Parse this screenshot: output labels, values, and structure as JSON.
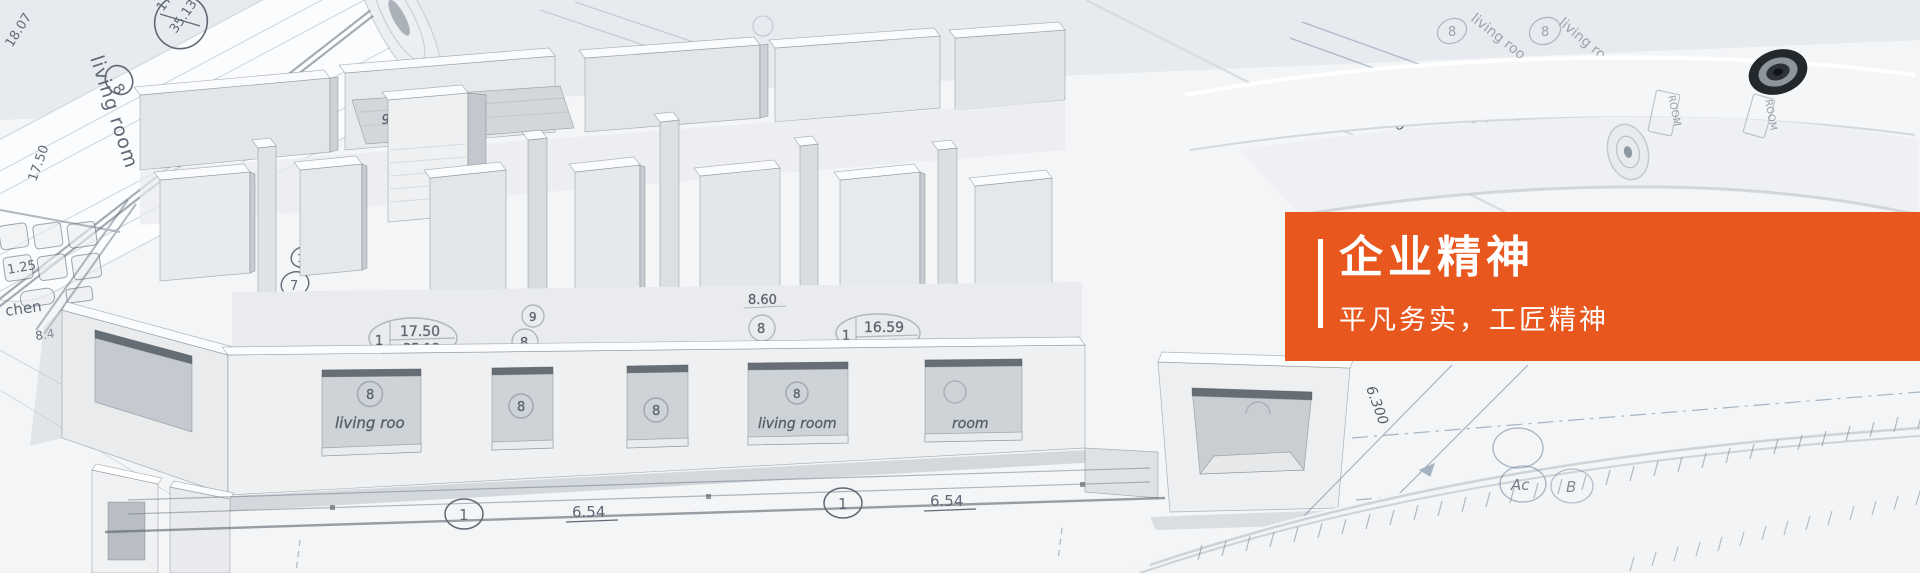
{
  "banner": {
    "title": "企业精神",
    "subtitle": "平凡务实，工匠精神",
    "accent_color": "#e8571e",
    "text_color": "#ffffff"
  },
  "blueprint_text": {
    "living_room": "living room",
    "living_room_partial": "living roo",
    "room_partial": "room",
    "kitchen_partial": "chen",
    "circle8": "8",
    "circle9": "9",
    "circle13": "13",
    "circle7": "7",
    "circle1": "1",
    "circle_ac": "Ac",
    "circle_b": "B",
    "stamp_tube_top": "17.50",
    "stamp_tube_bottom": "35.13",
    "stamp1_index": "1",
    "stamp1_top": "17.50",
    "stamp1_bottom": "35.13",
    "stamp2_index": "1",
    "stamp2_top": "16.59",
    "dim_18_07": "18.07",
    "dim_17_50": "17.50",
    "dim_1_25": "1.25",
    "dim_8_4": "8.4",
    "dim_8_60": "8.60",
    "dim_920": "920",
    "visor_label": "VisorNo1",
    "dim_6_54": "6.54",
    "dim_5550": "5550",
    "dim_6_300": "6.300",
    "dim_1200": "1200",
    "room_stamp": "ROOM"
  }
}
